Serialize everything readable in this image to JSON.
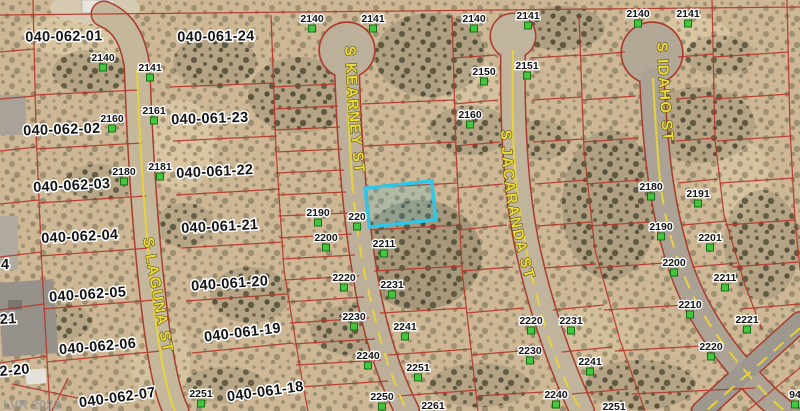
{
  "watermark": "LVR 2023",
  "colors": {
    "parcel_line": "#b5382b",
    "road_edge": "#a83c2e",
    "highlight": "#2fc6e8",
    "street_text": "#eedd3a",
    "address_marker": "#44c63e",
    "terrain": "#cdb795"
  },
  "streets": [
    {
      "name": "S LAGUNA ST"
    },
    {
      "name": "S KEARNEY ST"
    },
    {
      "name": "S JACARANDA ST"
    },
    {
      "name": "S IDAHO ST"
    }
  ],
  "parcel_ids": [
    {
      "t": "040-062-01",
      "x": 64,
      "y": 41,
      "r": -1
    },
    {
      "t": "040-061-24",
      "x": 216,
      "y": 41,
      "r": -1
    },
    {
      "t": "040-062-02",
      "x": 62,
      "y": 134,
      "r": -2
    },
    {
      "t": "040-061-23",
      "x": 210,
      "y": 123,
      "r": -2
    },
    {
      "t": "040-062-03",
      "x": 72,
      "y": 190,
      "r": -3
    },
    {
      "t": "040-061-22",
      "x": 215,
      "y": 176,
      "r": -3
    },
    {
      "t": "040-062-04",
      "x": 80,
      "y": 241,
      "r": -3
    },
    {
      "t": "040-061-21",
      "x": 220,
      "y": 231,
      "r": -3
    },
    {
      "t": "040-062-05",
      "x": 88,
      "y": 299,
      "r": -4
    },
    {
      "t": "040-061-20",
      "x": 230,
      "y": 288,
      "r": -4
    },
    {
      "t": "040-062-06",
      "x": 98,
      "y": 351,
      "r": -5
    },
    {
      "t": "040-061-19",
      "x": 243,
      "y": 337,
      "r": -7
    },
    {
      "t": "040-062-07",
      "x": 118,
      "y": 402,
      "r": -8
    },
    {
      "t": "040-061-18",
      "x": 266,
      "y": 396,
      "r": -8
    }
  ],
  "partial_parcel_ids": [
    {
      "t": "4",
      "x": 1,
      "y": 269,
      "r": 0
    },
    {
      "t": "21",
      "x": 0,
      "y": 324,
      "r": -3
    },
    {
      "t": "2-20",
      "x": 0,
      "y": 376,
      "r": -5
    }
  ],
  "addresses": [
    {
      "t": "2140",
      "x": 103,
      "y": 61
    },
    {
      "t": "2141",
      "x": 150,
      "y": 71
    },
    {
      "t": "2160",
      "x": 112,
      "y": 122
    },
    {
      "t": "2161",
      "x": 154,
      "y": 114
    },
    {
      "t": "2180",
      "x": 124,
      "y": 175
    },
    {
      "t": "2181",
      "x": 160,
      "y": 170
    },
    {
      "t": "2140",
      "x": 312,
      "y": 22
    },
    {
      "t": "2141",
      "x": 373,
      "y": 22
    },
    {
      "t": "2140",
      "x": 474,
      "y": 22
    },
    {
      "t": "2141",
      "x": 528,
      "y": 19
    },
    {
      "t": "2140",
      "x": 638,
      "y": 17
    },
    {
      "t": "2141",
      "x": 688,
      "y": 17
    },
    {
      "t": "2150",
      "x": 484,
      "y": 75
    },
    {
      "t": "2151",
      "x": 527,
      "y": 69
    },
    {
      "t": "2160",
      "x": 470,
      "y": 118
    },
    {
      "t": "2190",
      "x": 318,
      "y": 216
    },
    {
      "t": "220",
      "x": 357,
      "y": 220
    },
    {
      "t": "2200",
      "x": 326,
      "y": 241
    },
    {
      "t": "2211",
      "x": 384,
      "y": 247
    },
    {
      "t": "2220",
      "x": 344,
      "y": 281
    },
    {
      "t": "2231",
      "x": 392,
      "y": 288
    },
    {
      "t": "2230",
      "x": 354,
      "y": 320
    },
    {
      "t": "2241",
      "x": 405,
      "y": 330
    },
    {
      "t": "2240",
      "x": 368,
      "y": 359
    },
    {
      "t": "2251",
      "x": 418,
      "y": 371
    },
    {
      "t": "2250",
      "x": 382,
      "y": 400
    },
    {
      "t": "2261",
      "x": 433,
      "y": 409
    },
    {
      "t": "2220",
      "x": 531,
      "y": 324
    },
    {
      "t": "2231",
      "x": 571,
      "y": 324
    },
    {
      "t": "2230",
      "x": 530,
      "y": 354
    },
    {
      "t": "2241",
      "x": 590,
      "y": 365
    },
    {
      "t": "2240",
      "x": 556,
      "y": 398
    },
    {
      "t": "2251",
      "x": 614,
      "y": 410
    },
    {
      "t": "2251",
      "x": 201,
      "y": 397
    },
    {
      "t": "2180",
      "x": 651,
      "y": 190
    },
    {
      "t": "2191",
      "x": 698,
      "y": 197
    },
    {
      "t": "2190",
      "x": 661,
      "y": 230
    },
    {
      "t": "2201",
      "x": 710,
      "y": 241
    },
    {
      "t": "2200",
      "x": 674,
      "y": 266
    },
    {
      "t": "2211",
      "x": 725,
      "y": 281
    },
    {
      "t": "2210",
      "x": 690,
      "y": 308
    },
    {
      "t": "2221",
      "x": 747,
      "y": 323
    },
    {
      "t": "2220",
      "x": 711,
      "y": 350
    },
    {
      "t": "94",
      "x": 795,
      "y": 398
    }
  ]
}
